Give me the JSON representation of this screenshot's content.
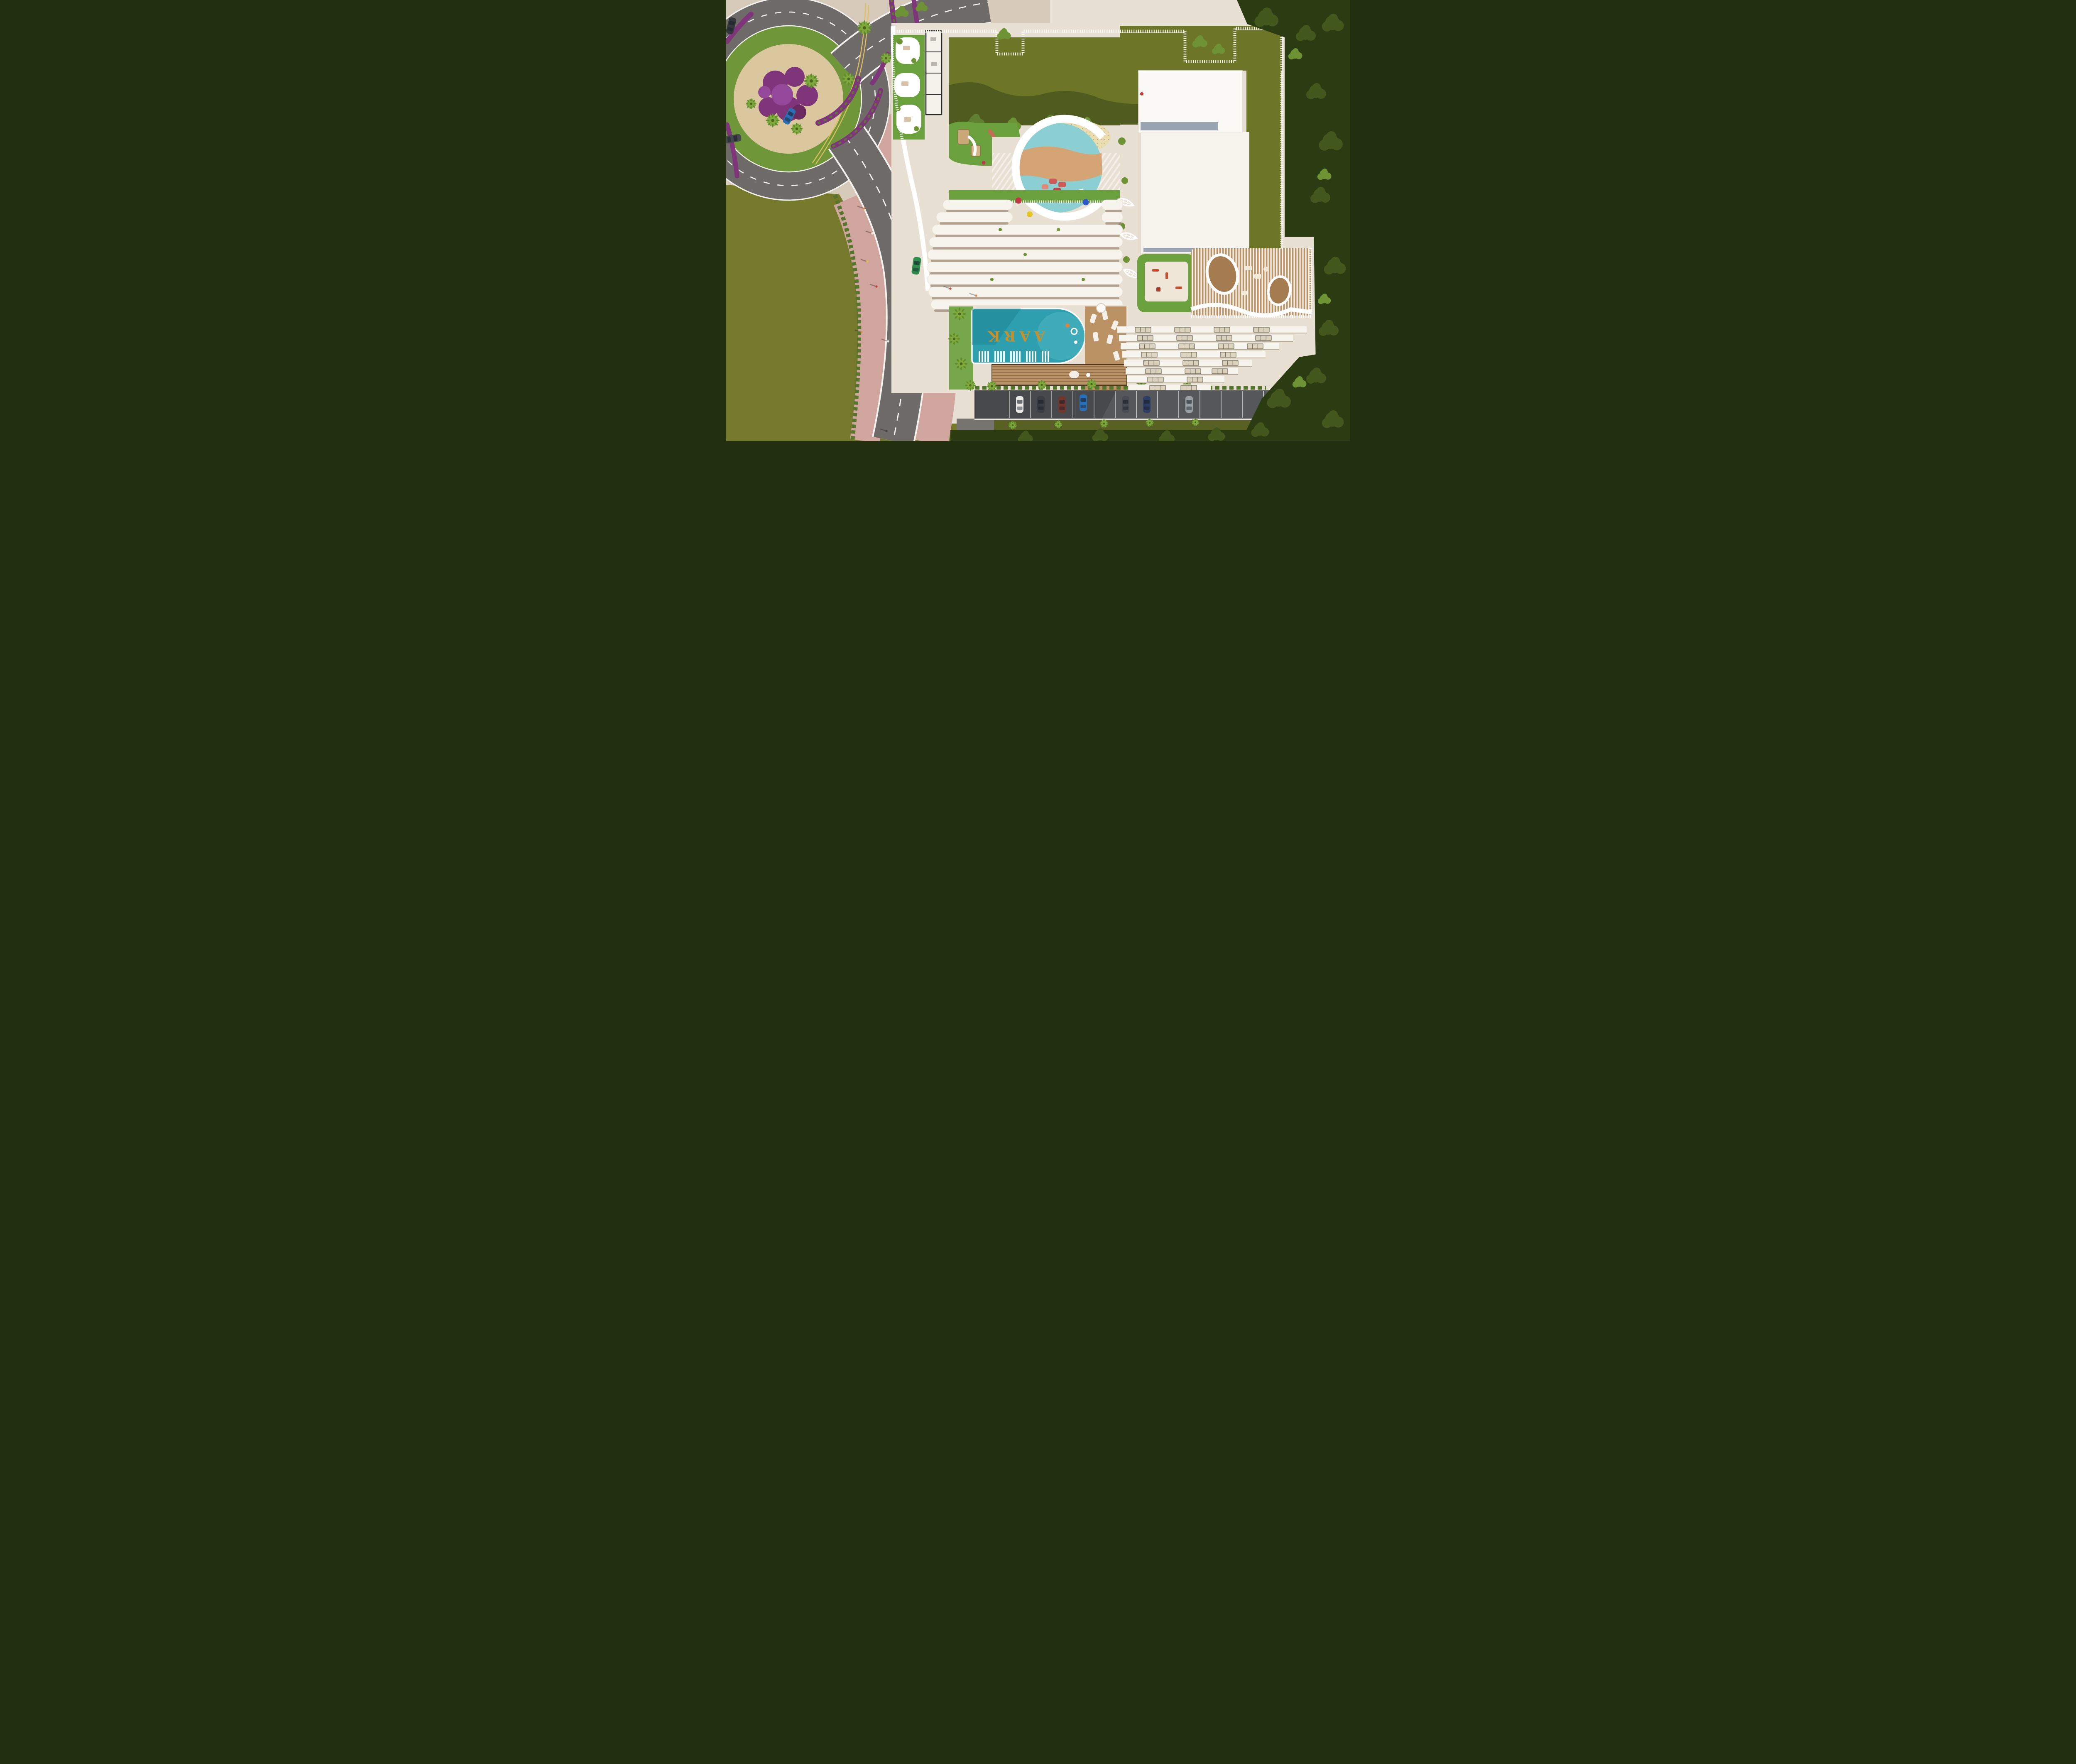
{
  "scene": {
    "type": "aerial-architectural-rendering",
    "description": "Top-down aerial 3D rendering of the AARK residential tower: rooftop amenity podium with lawn, playground and sunken circular lounge, wavy balcony high-rise, turquoise pool with gold AARK logo, slatted spa terrace, stepped lower wing, street-level parking, roundabout road with landscaped promenade",
    "pool_logo": "AARK"
  },
  "palette": {
    "beige": "#d6cabb",
    "pink": "#d0a59d",
    "asphalt": "#6f6b69",
    "asphalt-dark": "#56575b",
    "olive": "#75792c",
    "olive-dark": "#596023",
    "grass-ring": "#6f9638",
    "bright-lawn": "#6aa13c",
    "roof-lawn": "#6d7627",
    "trees-dark": "#2b3c12",
    "trees-mid": "#42581c",
    "trees-bright": "#6d9334",
    "white": "#f7f4ee",
    "shadow-warm": "#a28d78",
    "pavement": "#e8e0d3",
    "wood": "#bb9264",
    "wood-dark": "#a47c50",
    "pool": "#2d9fae",
    "pool-dark": "#1f8494",
    "pool-light": "#53b9c4",
    "gold": "#c3922e",
    "sand": "#e9dcae",
    "mural-teal": "#8ccfd2",
    "mural-orange": "#d9a170",
    "purple": "#7e3579",
    "hedge": "#55752c",
    "skylight": "#9aa5b4",
    "yellow-line": "#e0c05e",
    "island-sand": "#dbc79e"
  },
  "cars": {
    "road": [
      {
        "name": "blue-sedan-roundabout",
        "color": "#2d6db3"
      },
      {
        "name": "grey-suv-left-edge",
        "color": "#45484c"
      },
      {
        "name": "dark-car-top-left",
        "color": "#34373b"
      },
      {
        "name": "green-convertible-dropoff",
        "color": "#2f8d4e"
      }
    ],
    "parking": [
      {
        "name": "white-car",
        "color": "#e9e9e6"
      },
      {
        "name": "dark-grey-car",
        "color": "#3a3d42"
      },
      {
        "name": "maroon-car",
        "color": "#74352d"
      },
      {
        "name": "blue-car",
        "color": "#2b6fb5"
      },
      {
        "name": "grey-car",
        "color": "#494c52"
      },
      {
        "name": "navy-car",
        "color": "#2e3f66"
      },
      {
        "name": "silver-car",
        "color": "#9aa0a6"
      }
    ]
  },
  "people": [
    "#d98a4f",
    "#eeeae2",
    "#e0c040",
    "#c04038",
    "#d98a4f",
    "#f0ede6",
    "#444444",
    "#c04038",
    "#d98a4f"
  ],
  "beanbags": [
    {
      "name": "red-beanbag",
      "color": "#c23746"
    },
    {
      "name": "blue-beanbag",
      "color": "#2d59c9"
    },
    {
      "name": "yellow-beanbag",
      "color": "#e5c522"
    }
  ],
  "counts": {
    "tower_balcony_bands": 11,
    "lower_wing_floor_rows": 8,
    "parking_bays": 13,
    "parked_cars": 7
  }
}
